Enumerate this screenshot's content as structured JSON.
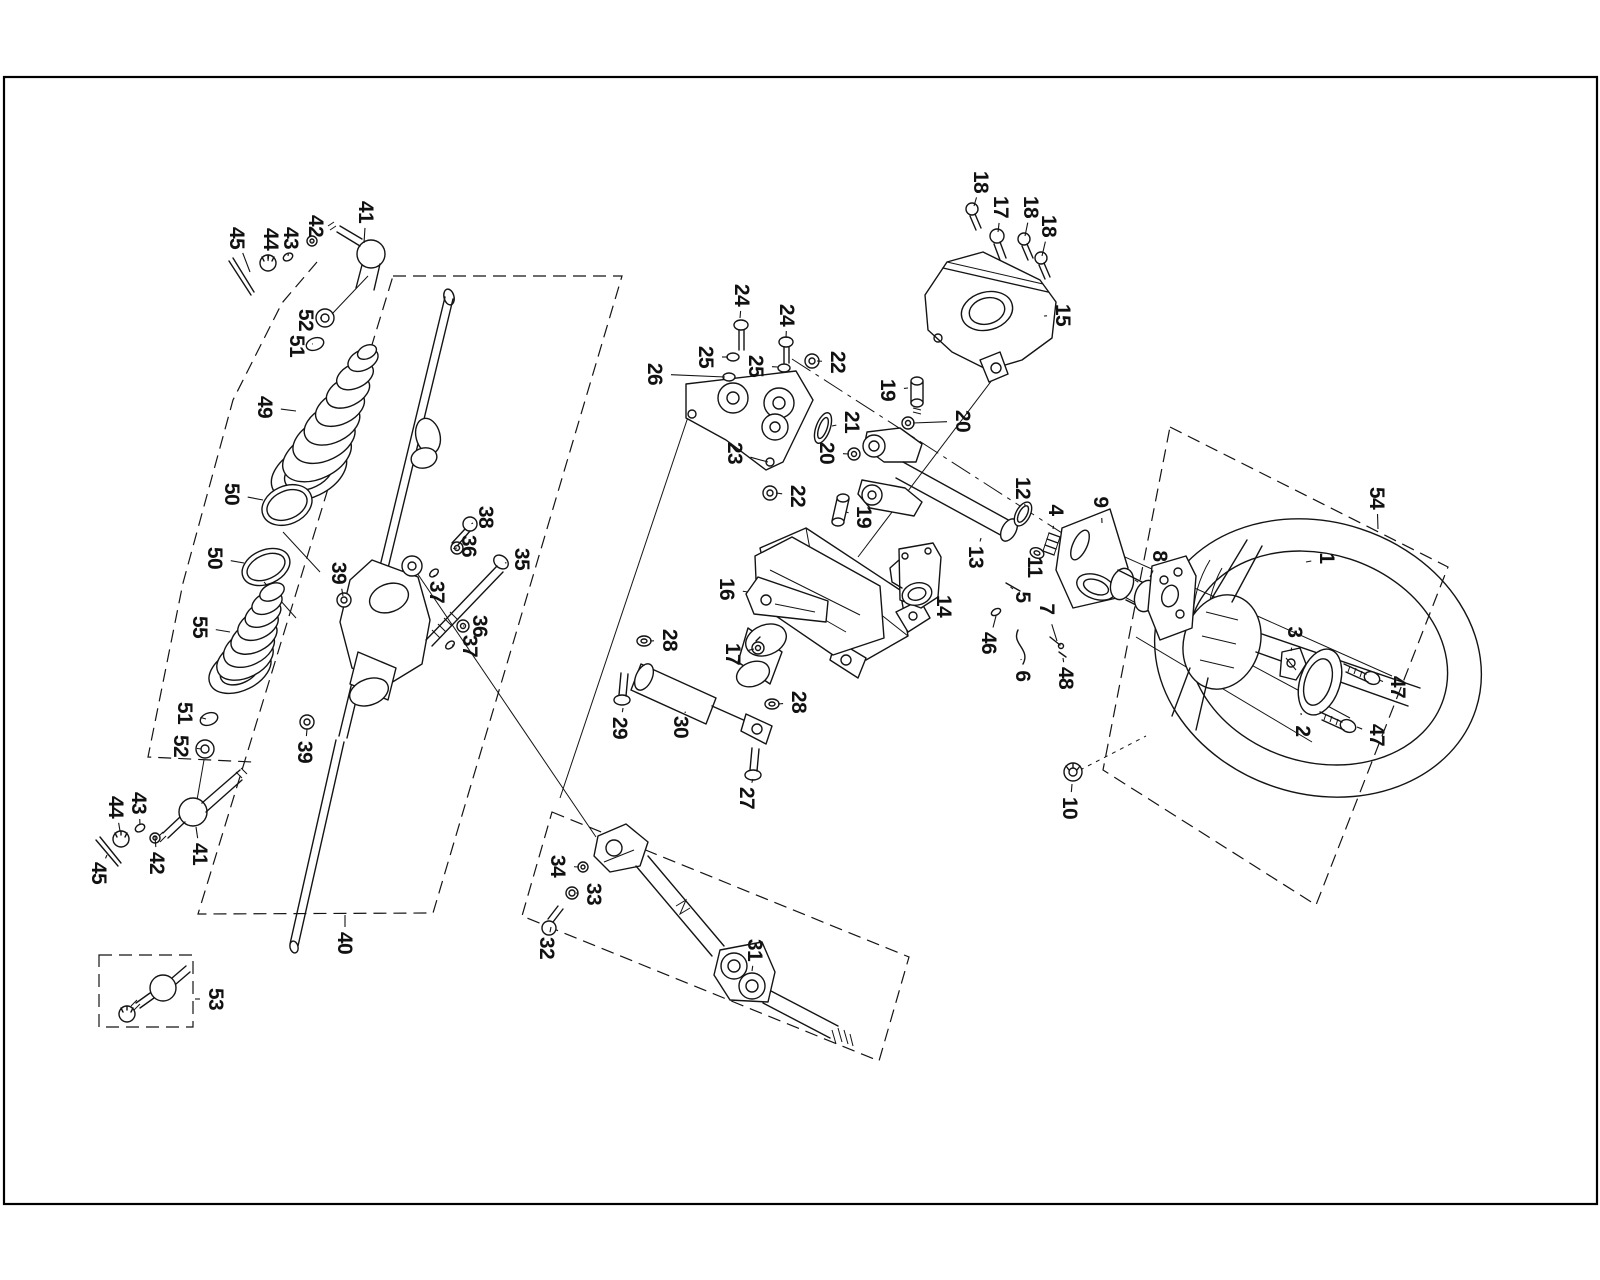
{
  "figure": {
    "kind": "exploded-parts-diagram",
    "ink_color": "#141414",
    "background_color": "#ffffff",
    "frame": {
      "x": 3,
      "y": 76,
      "width": 1594,
      "height": 1128
    }
  },
  "callouts": [
    {
      "n": "45",
      "x": 237,
      "y": 238,
      "tx": 250,
      "ty": 272
    },
    {
      "n": "44",
      "x": 271,
      "y": 239,
      "tx": 268,
      "ty": 261
    },
    {
      "n": "43",
      "x": 291,
      "y": 238,
      "tx": 288,
      "ty": 256
    },
    {
      "n": "42",
      "x": 316,
      "y": 226,
      "tx": 312,
      "ty": 241
    },
    {
      "n": "41",
      "x": 366,
      "y": 212,
      "tx": 364,
      "ty": 243
    },
    {
      "n": "52",
      "x": 306,
      "y": 320,
      "tx": 320,
      "ty": 318
    },
    {
      "n": "51",
      "x": 297,
      "y": 346,
      "tx": 312,
      "ty": 344
    },
    {
      "n": "49",
      "x": 265,
      "y": 407,
      "tx": 296,
      "ty": 411
    },
    {
      "n": "50",
      "x": 232,
      "y": 494,
      "tx": 263,
      "ty": 500
    },
    {
      "n": "50",
      "x": 215,
      "y": 558,
      "tx": 244,
      "ty": 563
    },
    {
      "n": "55",
      "x": 200,
      "y": 627,
      "tx": 230,
      "ty": 632
    },
    {
      "n": "51",
      "x": 185,
      "y": 713,
      "tx": 206,
      "ty": 719
    },
    {
      "n": "52",
      "x": 181,
      "y": 746,
      "tx": 201,
      "ty": 749
    },
    {
      "n": "39",
      "x": 339,
      "y": 573,
      "tx": 343,
      "ty": 596
    },
    {
      "n": "39",
      "x": 305,
      "y": 752,
      "tx": 307,
      "ty": 729
    },
    {
      "n": "38",
      "x": 486,
      "y": 517,
      "tx": 473,
      "ty": 523
    },
    {
      "n": "36",
      "x": 469,
      "y": 546,
      "tx": 457,
      "ty": 548
    },
    {
      "n": "37",
      "x": 437,
      "y": 592,
      "tx": 434,
      "ty": 575
    },
    {
      "n": "35",
      "x": 522,
      "y": 559,
      "tx": 505,
      "ty": 563
    },
    {
      "n": "36",
      "x": 480,
      "y": 626,
      "tx": 463,
      "ty": 626
    },
    {
      "n": "37",
      "x": 470,
      "y": 646,
      "tx": 452,
      "ty": 645
    },
    {
      "n": "40",
      "x": 345,
      "y": 943,
      "tx": 345,
      "ty": 915
    },
    {
      "n": "44",
      "x": 116,
      "y": 807,
      "tx": 120,
      "ty": 831
    },
    {
      "n": "43",
      "x": 139,
      "y": 803,
      "tx": 140,
      "ty": 825
    },
    {
      "n": "45",
      "x": 99,
      "y": 873,
      "tx": 107,
      "ty": 855
    },
    {
      "n": "42",
      "x": 157,
      "y": 863,
      "tx": 155,
      "ty": 836
    },
    {
      "n": "41",
      "x": 200,
      "y": 854,
      "tx": 196,
      "ty": 827
    },
    {
      "n": "53",
      "x": 216,
      "y": 999,
      "tx": 195,
      "ty": 999
    },
    {
      "n": "34",
      "x": 558,
      "y": 866,
      "tx": 579,
      "ty": 867
    },
    {
      "n": "33",
      "x": 594,
      "y": 894,
      "tx": 576,
      "ty": 893
    },
    {
      "n": "32",
      "x": 547,
      "y": 948,
      "tx": 551,
      "ty": 927
    },
    {
      "n": "31",
      "x": 755,
      "y": 950,
      "tx": 752,
      "ty": 971
    },
    {
      "n": "29",
      "x": 620,
      "y": 728,
      "tx": 623,
      "ty": 708
    },
    {
      "n": "30",
      "x": 681,
      "y": 727,
      "tx": 685,
      "ty": 713
    },
    {
      "n": "28",
      "x": 670,
      "y": 640,
      "tx": 650,
      "ty": 641
    },
    {
      "n": "28",
      "x": 799,
      "y": 702,
      "tx": 778,
      "ty": 704
    },
    {
      "n": "27",
      "x": 747,
      "y": 798,
      "tx": 753,
      "ty": 779
    },
    {
      "n": "16",
      "x": 727,
      "y": 589,
      "tx": 748,
      "ty": 592
    },
    {
      "n": "17",
      "x": 733,
      "y": 654,
      "tx": 754,
      "ty": 649
    },
    {
      "n": "26",
      "x": 655,
      "y": 374,
      "tx": 725,
      "ty": 377
    },
    {
      "n": "25",
      "x": 706,
      "y": 357,
      "tx": 728,
      "ty": 357
    },
    {
      "n": "24",
      "x": 742,
      "y": 295,
      "tx": 740,
      "ty": 318
    },
    {
      "n": "25",
      "x": 756,
      "y": 366,
      "tx": 778,
      "ty": 367
    },
    {
      "n": "24",
      "x": 787,
      "y": 315,
      "tx": 786,
      "ty": 338
    },
    {
      "n": "22",
      "x": 838,
      "y": 362,
      "tx": 817,
      "ty": 361
    },
    {
      "n": "19",
      "x": 888,
      "y": 390,
      "tx": 908,
      "ty": 388
    },
    {
      "n": "21",
      "x": 852,
      "y": 422,
      "tx": 832,
      "ty": 426
    },
    {
      "n": "20",
      "x": 963,
      "y": 421,
      "tx": 913,
      "ty": 423
    },
    {
      "n": "20",
      "x": 827,
      "y": 453,
      "tx": 849,
      "ty": 454
    },
    {
      "n": "23",
      "x": 735,
      "y": 453,
      "tx": 768,
      "ty": 462
    },
    {
      "n": "22",
      "x": 798,
      "y": 496,
      "tx": 776,
      "ty": 493
    },
    {
      "n": "19",
      "x": 864,
      "y": 517,
      "tx": 846,
      "ty": 512
    },
    {
      "n": "14",
      "x": 944,
      "y": 606,
      "tx": 929,
      "ty": 598
    },
    {
      "n": "46",
      "x": 989,
      "y": 643,
      "tx": 996,
      "ty": 616
    },
    {
      "n": "13",
      "x": 976,
      "y": 557,
      "tx": 981,
      "ty": 538
    },
    {
      "n": "12",
      "x": 1023,
      "y": 488,
      "tx": 1025,
      "ty": 506
    },
    {
      "n": "4",
      "x": 1056,
      "y": 510,
      "tx": 1053,
      "ty": 529
    },
    {
      "n": "11",
      "x": 1035,
      "y": 567,
      "tx": 1037,
      "ty": 551
    },
    {
      "n": "9",
      "x": 1101,
      "y": 502,
      "tx": 1102,
      "ty": 523
    },
    {
      "n": "5",
      "x": 1023,
      "y": 597,
      "tx": 1013,
      "ty": 589
    },
    {
      "n": "7",
      "x": 1047,
      "y": 609,
      "tx": 1057,
      "ty": 641
    },
    {
      "n": "48",
      "x": 1066,
      "y": 678,
      "tx": 1063,
      "ty": 658
    },
    {
      "n": "6",
      "x": 1023,
      "y": 676,
      "tx": 1021,
      "ty": 659
    },
    {
      "n": "8",
      "x": 1160,
      "y": 556,
      "tx": 1150,
      "ty": 577
    },
    {
      "n": "15",
      "x": 1063,
      "y": 315,
      "tx": 1044,
      "ty": 316
    },
    {
      "n": "17",
      "x": 1001,
      "y": 207,
      "tx": 998,
      "ty": 232
    },
    {
      "n": "18",
      "x": 981,
      "y": 182,
      "tx": 974,
      "ty": 206
    },
    {
      "n": "18",
      "x": 1031,
      "y": 207,
      "tx": 1025,
      "ty": 236
    },
    {
      "n": "18",
      "x": 1049,
      "y": 226,
      "tx": 1042,
      "ty": 256
    },
    {
      "n": "10",
      "x": 1070,
      "y": 808,
      "tx": 1072,
      "ty": 784
    },
    {
      "n": "1",
      "x": 1327,
      "y": 558,
      "tx": 1306,
      "ty": 562
    },
    {
      "n": "54",
      "x": 1377,
      "y": 498,
      "tx": 1378,
      "ty": 529
    },
    {
      "n": "3",
      "x": 1295,
      "y": 632,
      "tx": 1291,
      "ty": 651
    },
    {
      "n": "2",
      "x": 1303,
      "y": 731,
      "tx": 1301,
      "ty": 713
    },
    {
      "n": "47",
      "x": 1398,
      "y": 687,
      "tx": 1379,
      "ty": 680
    },
    {
      "n": "47",
      "x": 1377,
      "y": 735,
      "tx": 1357,
      "ty": 727
    }
  ]
}
